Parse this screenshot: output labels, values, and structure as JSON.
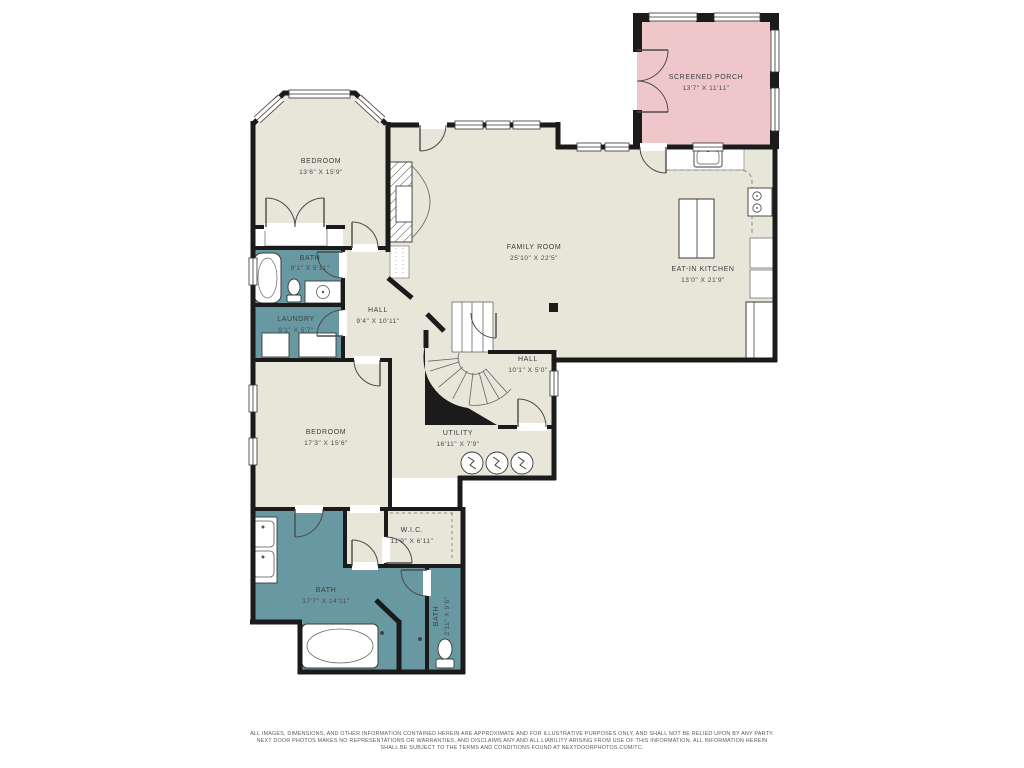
{
  "colors": {
    "floor": "#e8e5d9",
    "wet_room": "#6899a2",
    "porch": "#efc7cb",
    "wall": "#1b1b1b",
    "label": "#3d3d3d"
  },
  "rooms": [
    {
      "id": "screened-porch",
      "name": "SCREENED PORCH",
      "dims": "13'7\" X 11'11\""
    },
    {
      "id": "bedroom-1",
      "name": "BEDROOM",
      "dims": "13'6\" X 15'9\""
    },
    {
      "id": "family-room",
      "name": "FAMILY ROOM",
      "dims": "25'10\" X 22'5\""
    },
    {
      "id": "eat-in-kitchen",
      "name": "EAT-IN KITCHEN",
      "dims": "13'0\" X 21'9\""
    },
    {
      "id": "bath-1",
      "name": "BATH",
      "dims": "9'1\" X 5'11\""
    },
    {
      "id": "laundry",
      "name": "LAUNDRY",
      "dims": "9'1\" X 5'7\""
    },
    {
      "id": "hall-1",
      "name": "HALL",
      "dims": "9'4\" X 10'11\""
    },
    {
      "id": "hall-2",
      "name": "HALL",
      "dims": "10'1\" X 5'0\""
    },
    {
      "id": "bedroom-2",
      "name": "BEDROOM",
      "dims": "17'3\" X 15'6\""
    },
    {
      "id": "utility",
      "name": "UTILITY",
      "dims": "16'11\" X 7'9\""
    },
    {
      "id": "wic",
      "name": "W.I.C.",
      "dims": "11'9\" X 6'11\""
    },
    {
      "id": "bath-2",
      "name": "BATH",
      "dims": "17'7\" X 14'11\""
    },
    {
      "id": "bath-3",
      "name": "BATH",
      "dims": "2'11\" X 9'6\""
    }
  ],
  "disclaimer": {
    "line1": "ALL IMAGES, DIMENSIONS, AND OTHER INFORMATION CONTAINED HEREIN ARE APPROXIMATE AND FOR ILLUSTRATIVE PURPOSES ONLY, AND SHALL NOT BE RELIED UPON BY ANY PARTY.",
    "line2": "NEXT DOOR PHOTOS MAKES NO REPRESENTATIONS OR WARRANTIES, AND DISCLAIMS ANY AND ALL LIABILITY ARISING FROM USE OF THIS INFORMATION. ALL INFORMATION HEREIN",
    "line3": "SHALL BE SUBJECT TO THE TERMS AND CONDITIONS FOUND AT NEXTDOORPHOTOS.COM/TC."
  }
}
